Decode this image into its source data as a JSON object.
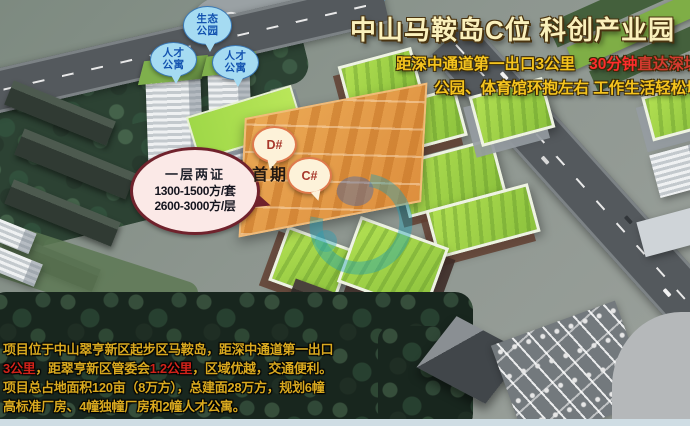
{
  "title": "中山马鞍岛C位  科创产业园",
  "subtitle": {
    "line1": {
      "part1": "距深中通道第一出口3公里",
      "part2": "30分钟",
      "part3": "直达深圳宝"
    },
    "line2": "公园、体育馆环抱左右  工作生活轻松切"
  },
  "map_labels": {
    "eco_park": "生态公园",
    "talent_apartment_left": "人才公寓",
    "talent_apartment_right": "人才公寓",
    "block_d": "D#",
    "block_c": "C#",
    "first_phase": "首期"
  },
  "info_bubble": {
    "line1": "一层两证",
    "line2": "1300-1500方/套",
    "line3": "2600-3000方/层"
  },
  "description": {
    "line1": "项目位于中山翠亨新区起步区马鞍岛，距深中通道第一出口",
    "line2_red1": "3公里",
    "line2_part2": "，距翠亨新区管委会",
    "line2_red2": "1.2公里",
    "line2_part3": "，区域优越，交通便利。",
    "line3": "项目总占地面积120亩（8万方），总建面28万方，规划6幢",
    "line4": "高标准厂房、4幢独幢厂房和2幢人才公寓。"
  },
  "colors": {
    "title_text": "#faf0bb",
    "subtitle_yellow": "#f5c41e",
    "highlight_red": "#ff2d2d",
    "description_yellow": "#d9a91f",
    "description_red": "#d2231a",
    "bubble_blue_bg": "#a5dbf2",
    "bubble_blue_text": "#1353b0",
    "phase_zone_orange": "#e6a24f",
    "green_roof": "#9ed047"
  }
}
